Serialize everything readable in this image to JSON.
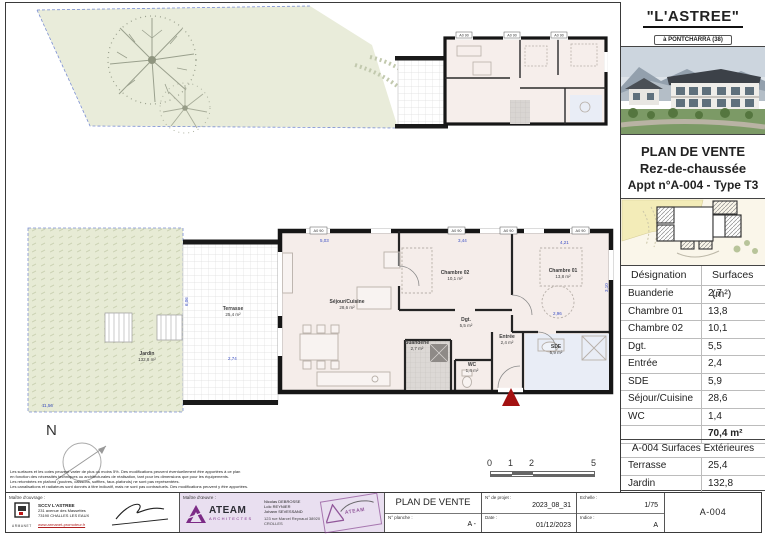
{
  "sidebar": {
    "title": "\"L'ASTREE\"",
    "subtitle": "à PONTCHARRA (38)",
    "plan_title_line1": "PLAN DE VENTE",
    "plan_title_line2": "Rez-de-chaussée",
    "plan_title_line3": "Appt n°A-004 - Type T3",
    "surfaces_table": {
      "headers": [
        "Désignation",
        "Surfaces (m²)"
      ],
      "rows": [
        [
          "Buanderie",
          "2,7"
        ],
        [
          "Chambre 01",
          "13,8"
        ],
        [
          "Chambre 02",
          "10,1"
        ],
        [
          "Dgt.",
          "5,5"
        ],
        [
          "Entrée",
          "2,4"
        ],
        [
          "SDE",
          "5,9"
        ],
        [
          "Séjour/Cuisine",
          "28,6"
        ],
        [
          "WC",
          "1,4"
        ]
      ],
      "total": "70,4 m²"
    },
    "ext_table": {
      "title": "A-004 Surfaces Extérieures",
      "rows": [
        [
          "Terrasse",
          "25,4"
        ],
        [
          "Jardin",
          "132,8"
        ]
      ]
    }
  },
  "plan": {
    "rooms": [
      {
        "name": "Séjour/Cuisine",
        "area": "28,6 m²"
      },
      {
        "name": "Chambre 02",
        "area": "10,1 m²"
      },
      {
        "name": "Chambre 01",
        "area": "13,8 m²"
      },
      {
        "name": "Dgt.",
        "area": "5,5 m²"
      },
      {
        "name": "Entrée",
        "area": "2,4 m²"
      },
      {
        "name": "WC",
        "area": "1,4 m²"
      },
      {
        "name": "SDE",
        "area": "5,9 m²"
      },
      {
        "name": "Buanderie",
        "area": "2,7 m²"
      },
      {
        "name": "Terrasse",
        "area": "25,4 m²"
      },
      {
        "name": "Jardin",
        "area": "132,8 m²"
      }
    ],
    "dims": [
      "5,03",
      "3,44",
      "4,21",
      "3,10",
      "2,96",
      "2,74",
      "11,56",
      "6,06"
    ],
    "window_tag": "A0 90",
    "north_label": "N",
    "scalebar_labels": [
      "0",
      "1",
      "2",
      "5"
    ]
  },
  "disclaimer": {
    "lines": [
      "Les surfaces et les cotes peuvent varier de plus ou moins 5%. Des modifications peuvent éventuellement être apportées à ce plan",
      "en fonction des nécessités techniques ou architecturales de réalisation, tant pour les dimensions que pour les équipements.",
      "Les retombées en plafond (poutres, caissons, soffites, faux-plafonds) ne sont pas représentées.",
      "Les canalisations et radiateurs sont donnés à titre indicatif, mais ne sont pas contractuels. Des modifications peuvent y être apportées."
    ]
  },
  "titleblock": {
    "owner_label": "Maître d'ouvrage :",
    "owner_logo": "ARMANET",
    "owner_name": "SCCV L'ASTREE",
    "owner_addr1": "231 avenue des Massettes",
    "owner_addr2": "73190 CHALLES LES EAUX",
    "owner_url": "www.armanet-promoteur.fr",
    "architect_label": "Maître d'œuvre :",
    "architect_logo": "ATEAM",
    "architect_logo_sub": "ARCHITECTES",
    "architect_names": [
      "Nicolas DEBROSSE",
      "Loïc REYNIER",
      "Johann SEVESSAND"
    ],
    "architect_addr": "123 rue Marcel Reynaud 38920 CROLLES",
    "stamp_text": "ATEAM",
    "doc_title": "PLAN DE VENTE",
    "labels": {
      "planche": "N° planche :",
      "projet": "N° de projet :",
      "date": "Date :",
      "echelle": "Echelle :",
      "indice": "Indice :"
    },
    "values": {
      "planche": "A -",
      "projet": "2023_08_31",
      "date": "01/12/2023",
      "echelle": "1/75",
      "indice": "A"
    },
    "sheet_ref": "A-004"
  },
  "colors": {
    "wall": "#1a1a1a",
    "room_fill": "#f5edea",
    "sde_fill": "#e9edf6",
    "garden_green": "#e8ecd9",
    "dim_blue": "#3a4ec4",
    "entry_red": "#a31111",
    "ateam_purple": "#7c2b86"
  }
}
